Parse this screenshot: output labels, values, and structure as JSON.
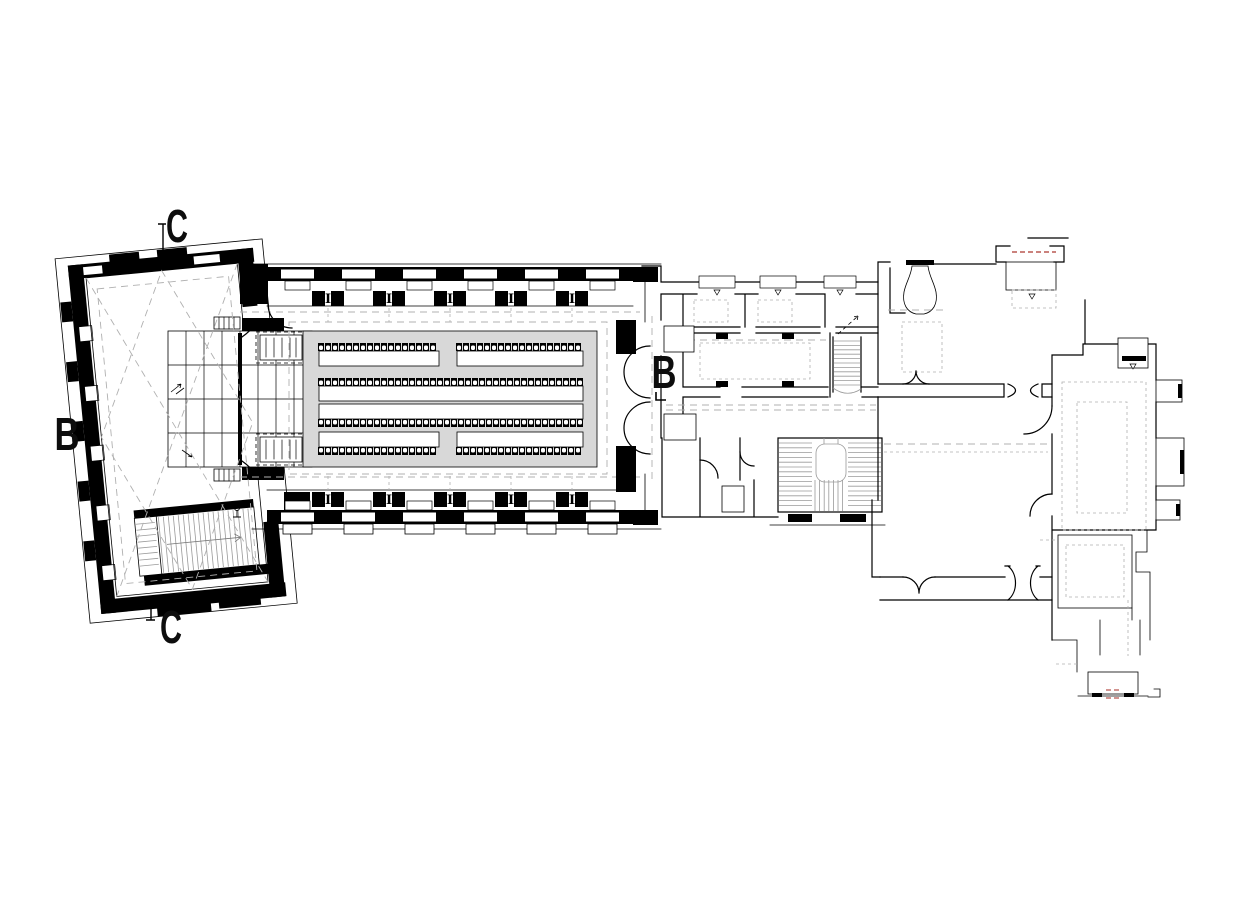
{
  "section_markers": {
    "c_top": "C",
    "c_bottom": "C",
    "b_left": "B",
    "b_mid": "B"
  },
  "hall": {
    "column_glyph": "I",
    "wall_modules": {
      "start": 267,
      "width": 61,
      "count": 6
    }
  },
  "seating": {
    "seat_pitch": 7,
    "seat_size": [
      6,
      8
    ],
    "bench_height": 15,
    "rows": [
      {
        "seats_y": 343,
        "bench_y": 351,
        "facing": "up",
        "segments": [
          [
            318,
            440
          ],
          [
            456,
            584
          ]
        ]
      },
      {
        "seats_y": 378,
        "bench_y": 386,
        "facing": "up",
        "segments": [
          [
            318,
            584
          ]
        ]
      },
      {
        "seats_y": 419,
        "bench_y": 404,
        "facing": "down",
        "segments": [
          [
            318,
            584
          ]
        ]
      },
      {
        "seats_y": 447,
        "bench_y": 432,
        "facing": "down",
        "segments": [
          [
            318,
            440
          ],
          [
            456,
            584
          ]
        ]
      }
    ]
  },
  "colors": {
    "line": "#000000",
    "guide": "#b0b0b0",
    "floor": "#d8d8d8",
    "red": "#c4706b",
    "background": "#ffffff"
  }
}
